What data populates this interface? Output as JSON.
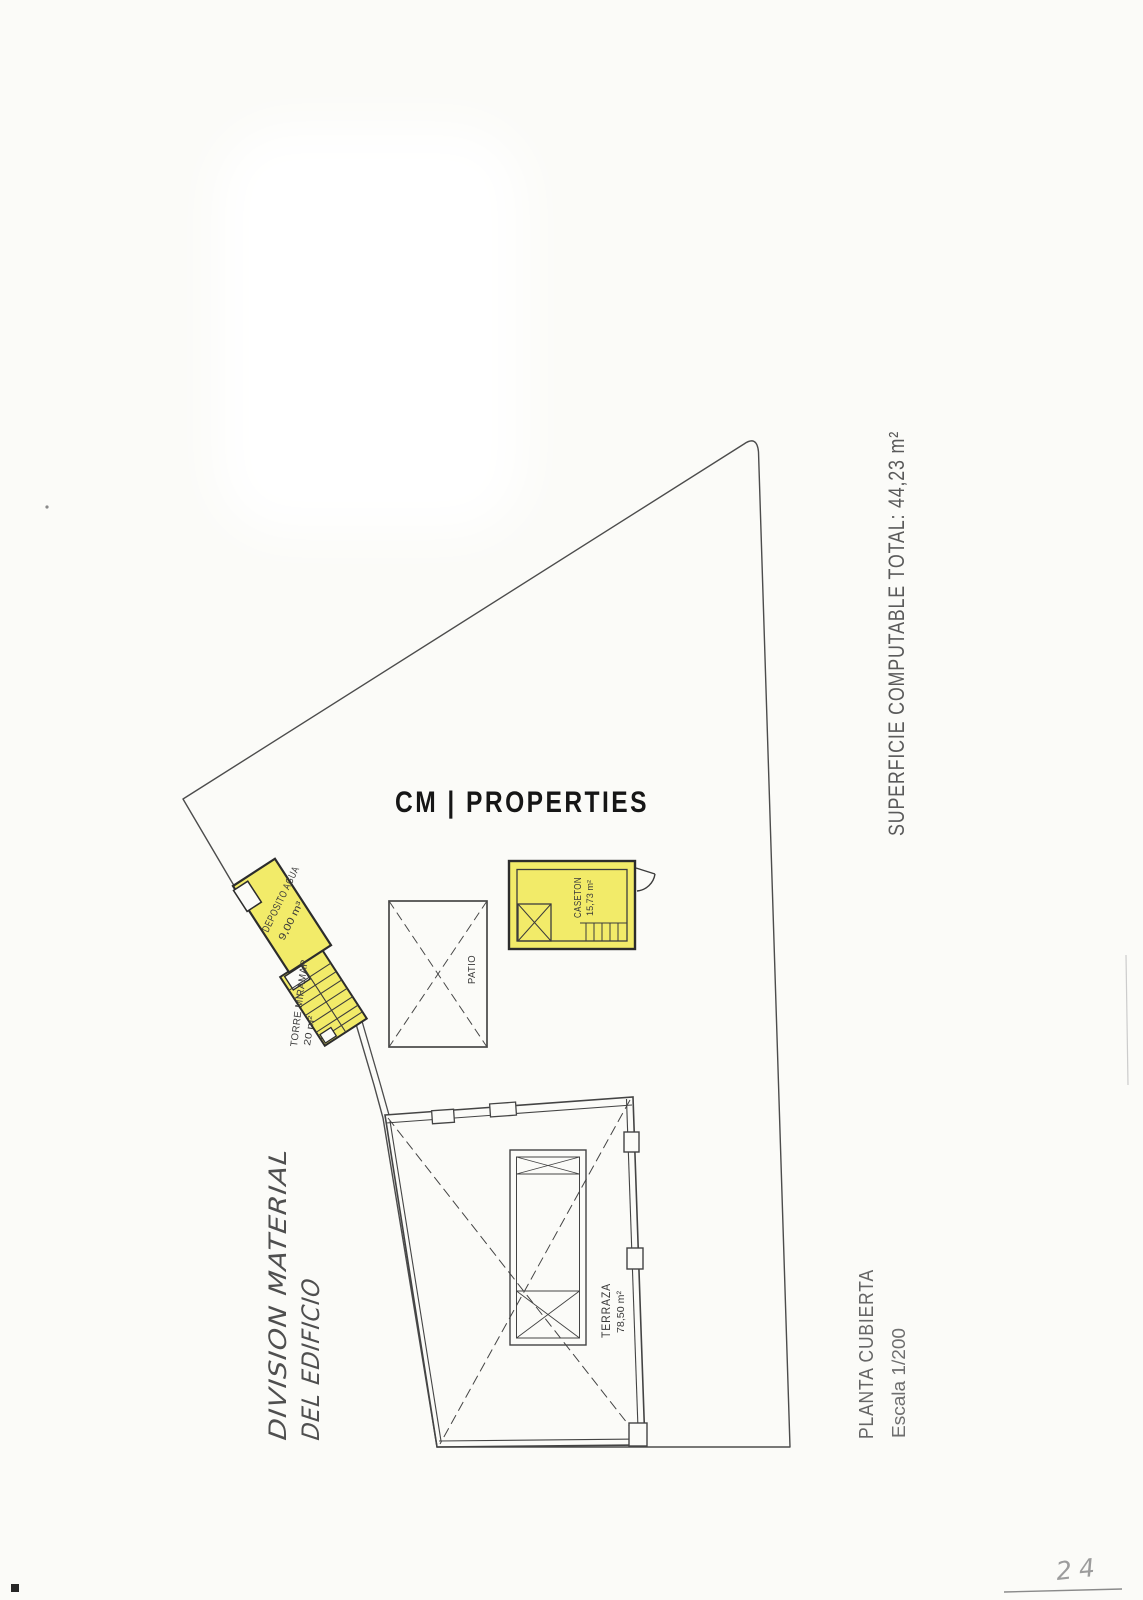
{
  "document": {
    "watermark": "CM | PROPERTIES",
    "summary_note": "SUPERFICIE COMPUTABLE TOTAL: 44,23 m²",
    "handwritten_title": {
      "line1": "DIVISION MATERIAL",
      "line2": "DEL EDIFICIO"
    },
    "plan_title": "PLANTA CUBIERTA",
    "plan_scale": "Escala 1/200",
    "page_number": "24"
  },
  "plan": {
    "rooms": {
      "deposito": {
        "label": "DEPOSITO AGUA",
        "area": "9,00 m³"
      },
      "torre": {
        "label": "TORRE MIRAMAR",
        "area": "20 m²"
      },
      "patio": {
        "label": "PATIO"
      },
      "caseton": {
        "label": "CASETON",
        "area": "15,73 m²"
      },
      "terraza": {
        "label": "TERRAZA",
        "area": "78,50 m²"
      }
    },
    "colors": {
      "highlight_yellow": "#f2eb69",
      "ink": "#3f3f3f",
      "paper": "#fbfbf8"
    }
  }
}
